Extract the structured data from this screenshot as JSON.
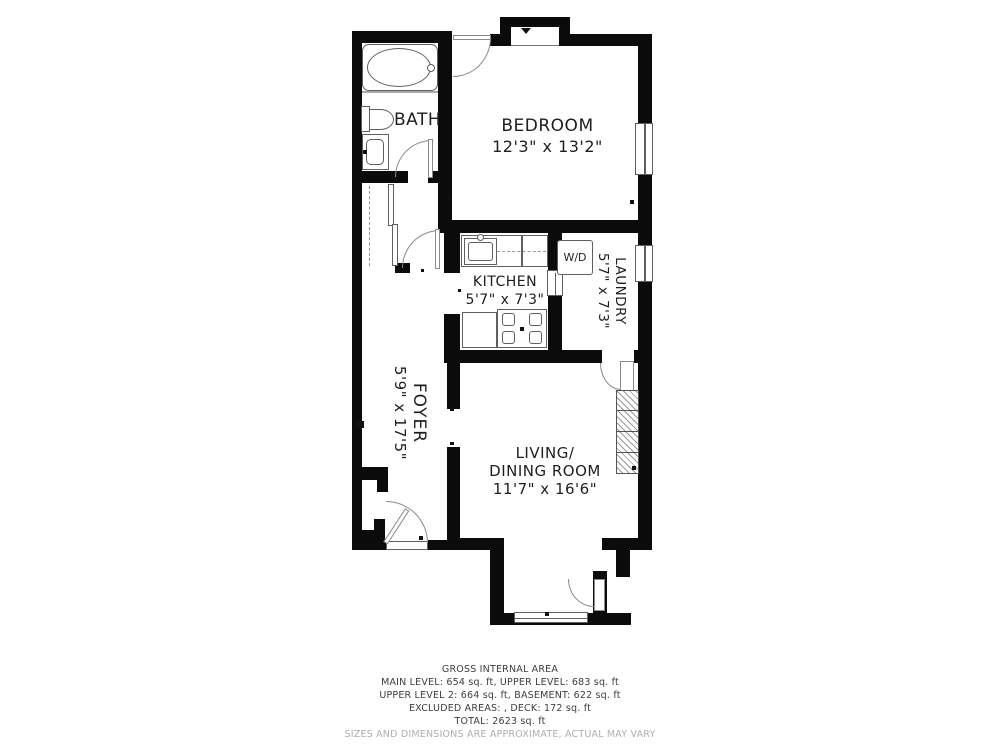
{
  "rooms": {
    "bath": {
      "name": "BATH"
    },
    "bedroom": {
      "name": "BEDROOM",
      "dims": "12'3\" x 13'2\""
    },
    "kitchen": {
      "name": "KITCHEN",
      "dims": "5'7\" x 7'3\""
    },
    "laundry": {
      "name": "LAUNDRY",
      "dims": "5'7\" x 7'3\""
    },
    "foyer": {
      "name": "FOYER",
      "dims": "5'9\" x 17'5\""
    },
    "living": {
      "name1": "LIVING/",
      "name2": "DINING ROOM",
      "dims": "11'7\" x 16'6\""
    }
  },
  "appliances": {
    "washer_dryer": "W/D"
  },
  "footer": {
    "title": "GROSS INTERNAL AREA",
    "line1": "MAIN LEVEL: 654 sq. ft, UPPER LEVEL: 683 sq. ft",
    "line2": "UPPER LEVEL 2: 664 sq. ft, BASEMENT: 622 sq. ft",
    "line3": "EXCLUDED AREAS: , DECK: 172 sq. ft",
    "line4": "TOTAL: 2623 sq. ft",
    "disclaimer": "SIZES AND DIMENSIONS ARE APPROXIMATE, ACTUAL MAY VARY"
  },
  "colors": {
    "wall": "#0b0b0b",
    "fixture_line": "#5f5f5f",
    "text": "#1e1e1e",
    "muted_text": "#aeaeae"
  }
}
